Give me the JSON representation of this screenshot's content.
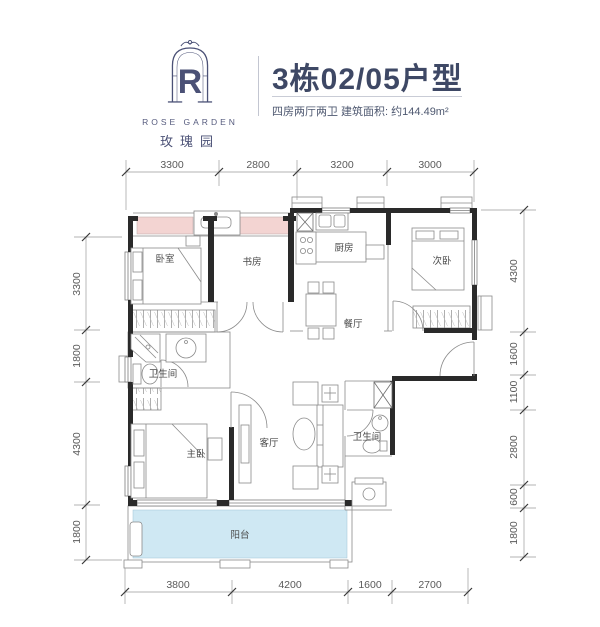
{
  "header": {
    "logo": {
      "letter": "R",
      "name_en": "ROSE GARDEN",
      "name_cn": "玫瑰园"
    },
    "title": "3栋02/05户型",
    "subtitle": "四房两厅两卫 建筑面积: 约144.49m²"
  },
  "floorplan": {
    "rooms": [
      {
        "id": "bedroom",
        "label": "卧室"
      },
      {
        "id": "study",
        "label": "书房"
      },
      {
        "id": "kitchen",
        "label": "厨房"
      },
      {
        "id": "second-bedroom",
        "label": "次卧"
      },
      {
        "id": "dining-room",
        "label": "餐厅"
      },
      {
        "id": "bathroom-1",
        "label": "卫生间"
      },
      {
        "id": "master-bedroom",
        "label": "主卧"
      },
      {
        "id": "living-room",
        "label": "客厅"
      },
      {
        "id": "bathroom-2",
        "label": "卫生间"
      },
      {
        "id": "balcony",
        "label": "阳台"
      }
    ],
    "dimensions_mm": {
      "top": [
        "3300",
        "2800",
        "3200",
        "3000"
      ],
      "left": [
        "3300",
        "1800",
        "4300",
        "1800"
      ],
      "right": [
        "4300",
        "1600",
        "1100",
        "2800",
        "600",
        "1800"
      ],
      "bottom": [
        "3800",
        "4200",
        "1600",
        "2700"
      ]
    },
    "colors": {
      "wall": "#2a2a2a",
      "bay_window": "#f3d4d2",
      "balcony": "#cfe8f3",
      "accent": "#3e4865"
    }
  }
}
